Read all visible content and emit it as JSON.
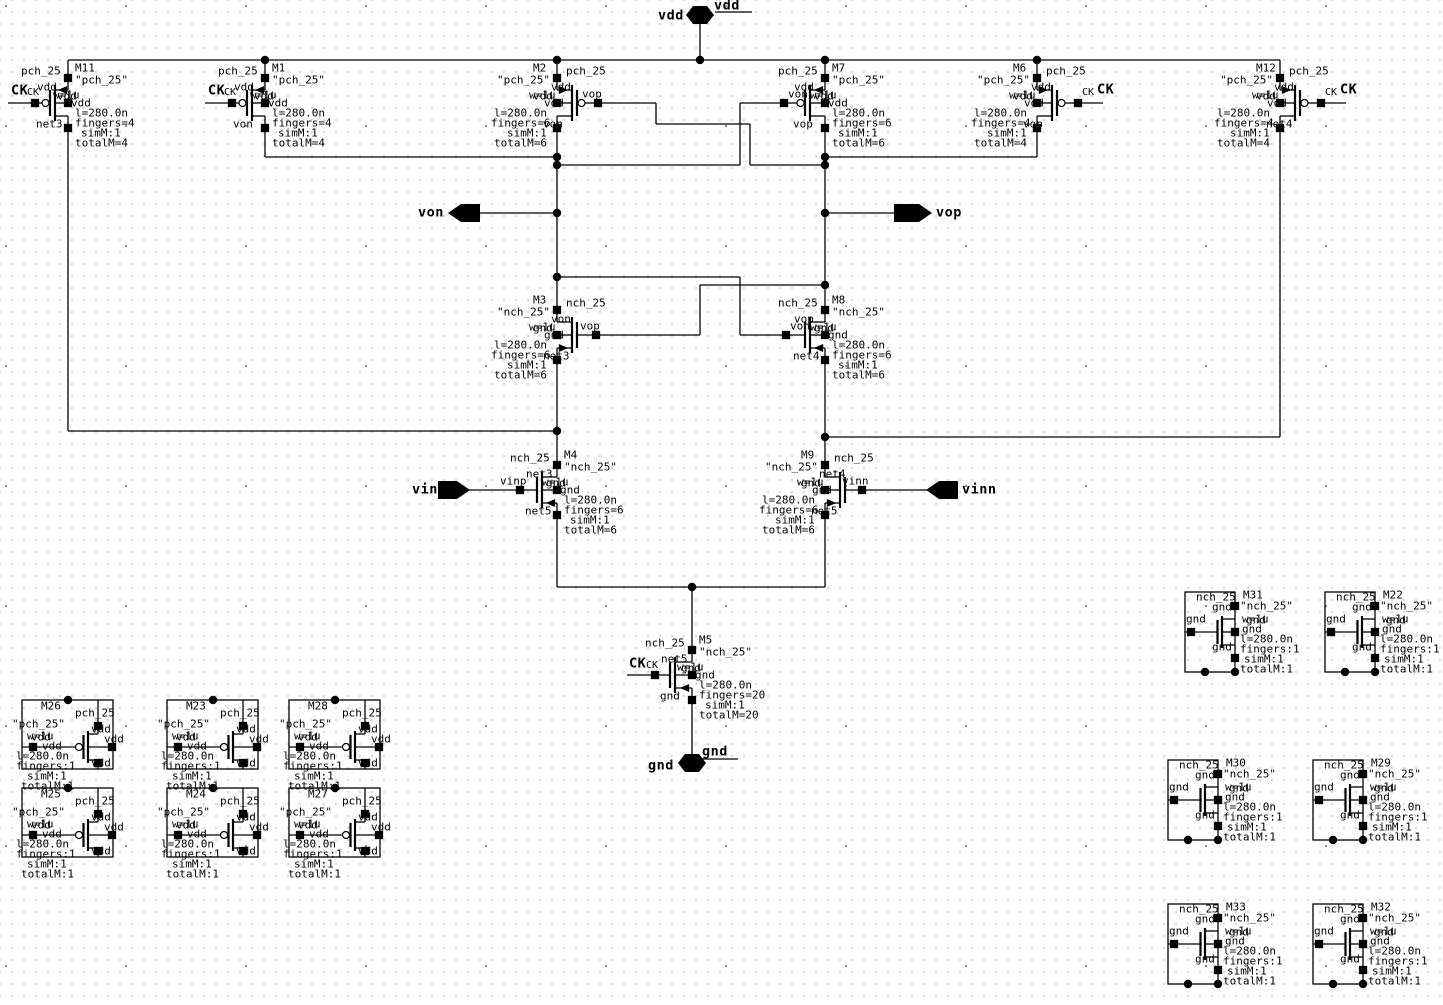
{
  "ports": {
    "vdd": "vdd",
    "gnd": "gnd",
    "von": "von",
    "vop": "vop",
    "vinp": "vinp",
    "vinn": "vinn"
  },
  "transistors": [
    {
      "id": "M11",
      "cell": "pch_25",
      "model": "\"pch_25\"",
      "w": "w=1u",
      "gate": "CK",
      "gate_pin": "CK",
      "pins": {
        "top": "vdd",
        "mid": "vdd",
        "bot": "net3"
      },
      "params": [
        "l=280.0n",
        "fingers=4",
        "simM:1",
        "totalM=4"
      ]
    },
    {
      "id": "M1",
      "cell": "pch_25",
      "model": "\"pch_25\"",
      "w": "w=1u",
      "gate": "CK",
      "gate_pin": "CK",
      "pins": {
        "top": "vdd",
        "mid": "vdd",
        "bot": "von"
      },
      "params": [
        "l=280.0n",
        "fingers=4",
        "simM:1",
        "totalM=4"
      ]
    },
    {
      "id": "M2",
      "cell": "pch_25",
      "model": "\"pch_25\"",
      "w": "w=1u",
      "gate": "vop",
      "pins": {
        "top": "vdd",
        "mid": "vdd",
        "bot": "von"
      },
      "params": [
        "l=280.0n",
        "fingers=6",
        "simM:1",
        "totalM=6"
      ]
    },
    {
      "id": "M7",
      "cell": "pch_25",
      "model": "\"pch_25\"",
      "w": "w=1u",
      "gate": "von",
      "pins": {
        "top": "vdd",
        "mid": "vdd",
        "bot": "vop"
      },
      "params": [
        "l=280.0n",
        "fingers=6",
        "simM:1",
        "totalM=6"
      ]
    },
    {
      "id": "M6",
      "cell": "pch_25",
      "model": "\"pch_25\"",
      "w": "w=1u",
      "gate": "CK",
      "gate_pin": "CK",
      "pins": {
        "top": "vdd",
        "mid": "vdd",
        "bot": "vop"
      },
      "params": [
        "l=280.0n",
        "fingers=4",
        "simM:1",
        "totalM=4"
      ]
    },
    {
      "id": "M12",
      "cell": "pch_25",
      "model": "\"pch_25\"",
      "w": "w=1u",
      "gate": "CK",
      "gate_pin": "CK",
      "pins": {
        "top": "vdd",
        "mid": "vdd",
        "bot": "net4"
      },
      "params": [
        "l=280.0n",
        "fingers=4",
        "simM:1",
        "totalM=4"
      ]
    },
    {
      "id": "M3",
      "cell": "nch_25",
      "model": "\"nch_25\"",
      "w": "w=1u",
      "gate": "vop",
      "pins": {
        "top": "von",
        "mid": "gnd",
        "bot": "net3"
      },
      "params": [
        "l=280.0n",
        "fingers=6",
        "simM:1",
        "totalM=6"
      ]
    },
    {
      "id": "M8",
      "cell": "nch_25",
      "model": "\"nch_25\"",
      "w": "w=1u",
      "gate": "von",
      "pins": {
        "top": "vop",
        "mid": "gnd",
        "bot": "net4"
      },
      "params": [
        "l=280.0n",
        "fingers=6",
        "simM:1",
        "totalM=6"
      ]
    },
    {
      "id": "M4",
      "cell": "nch_25",
      "model": "\"nch_25\"",
      "w": "w=1u",
      "gate": "vinp",
      "pins": {
        "top": "net3",
        "mid": "gnd",
        "bot": "net5"
      },
      "params": [
        "l=280.0n",
        "fingers=6",
        "simM:1",
        "totalM=6"
      ]
    },
    {
      "id": "M9",
      "cell": "nch_25",
      "model": "\"nch_25\"",
      "w": "w=1u",
      "gate": "vinn",
      "pins": {
        "top": "net4",
        "mid": "gnd",
        "bot": "net5"
      },
      "params": [
        "l=280.0n",
        "fingers=6",
        "simM:1",
        "totalM=6"
      ]
    },
    {
      "id": "M5",
      "cell": "nch_25",
      "model": "\"nch_25\"",
      "w": "w=1u",
      "gate": "CK",
      "gate_pin": "CK",
      "pins": {
        "top": "net5",
        "mid": "gnd",
        "bot": "gnd"
      },
      "params": [
        "l=280.0n",
        "fingers=20",
        "simM:1",
        "totalM=20"
      ]
    },
    {
      "id": "M26",
      "cell": "pch_25",
      "model": "\"pch_25\"",
      "w": "w=1u",
      "gate": "vdd",
      "pins": {
        "top": "vdd",
        "mid": "vdd",
        "bot": "vdd"
      },
      "params": [
        "l=280.0n",
        "fingers:1",
        "simM:1",
        "totalM:1"
      ]
    },
    {
      "id": "M25",
      "cell": "pch_25",
      "model": "\"pch_25\"",
      "w": "w=1u",
      "gate": "vdd",
      "pins": {
        "top": "vdd",
        "mid": "vdd",
        "bot": "vdd"
      },
      "params": [
        "l=280.0n",
        "fingers:1",
        "simM:1",
        "totalM:1"
      ]
    },
    {
      "id": "M23",
      "cell": "pch_25",
      "model": "\"pch_25\"",
      "w": "w=1u",
      "gate": "vdd",
      "pins": {
        "top": "vdd",
        "mid": "vdd",
        "bot": "vdd"
      },
      "params": [
        "l=280.0n",
        "fingers:1",
        "simM:1",
        "totalM:1"
      ]
    },
    {
      "id": "M24",
      "cell": "pch_25",
      "model": "\"pch_25\"",
      "w": "w=1u",
      "gate": "vdd",
      "pins": {
        "top": "vdd",
        "mid": "vdd",
        "bot": "vdd"
      },
      "params": [
        "l=280.0n",
        "fingers:1",
        "simM:1",
        "totalM:1"
      ]
    },
    {
      "id": "M28",
      "cell": "pch_25",
      "model": "\"pch_25\"",
      "w": "w=1u",
      "gate": "vdd",
      "pins": {
        "top": "vdd",
        "mid": "vdd",
        "bot": "vdd"
      },
      "params": [
        "l=280.0n",
        "fingers:1",
        "simM:1",
        "totalM:1"
      ]
    },
    {
      "id": "M27",
      "cell": "pch_25",
      "model": "\"pch_25\"",
      "w": "w=1u",
      "gate": "vdd",
      "pins": {
        "top": "vdd",
        "mid": "vdd",
        "bot": "vdd"
      },
      "params": [
        "l=280.0n",
        "fingers:1",
        "simM:1",
        "totalM:1"
      ]
    },
    {
      "id": "M31",
      "cell": "nch_25",
      "model": "\"nch_25\"",
      "w": "w=1u",
      "gate": "gnd",
      "pins": {
        "top": "gnd",
        "mid": "gnd",
        "bot": "gnd"
      },
      "params": [
        "l=280.0n",
        "fingers:1",
        "simM:1",
        "totalM:1"
      ]
    },
    {
      "id": "M22",
      "cell": "nch_25",
      "model": "\"nch_25\"",
      "w": "w=1u",
      "gate": "gnd",
      "pins": {
        "top": "gnd",
        "mid": "gnd",
        "bot": "gnd"
      },
      "params": [
        "l=280.0n",
        "fingers:1",
        "simM:1",
        "totalM:1"
      ]
    },
    {
      "id": "M30",
      "cell": "nch_25",
      "model": "\"nch_25\"",
      "w": "w=1u",
      "gate": "gnd",
      "pins": {
        "top": "gnd",
        "mid": "gnd",
        "bot": "gnd"
      },
      "params": [
        "l=280.0n",
        "fingers:1",
        "simM:1",
        "totalM:1"
      ]
    },
    {
      "id": "M29",
      "cell": "nch_25",
      "model": "\"nch_25\"",
      "w": "w=1u",
      "gate": "gnd",
      "pins": {
        "top": "gnd",
        "mid": "gnd",
        "bot": "gnd"
      },
      "params": [
        "l=280.0n",
        "fingers:1",
        "simM:1",
        "totalM:1"
      ]
    },
    {
      "id": "M33",
      "cell": "nch_25",
      "model": "\"nch_25\"",
      "w": "w=1u",
      "gate": "gnd",
      "pins": {
        "top": "gnd",
        "mid": "gnd",
        "bot": "gnd"
      },
      "params": [
        "l=280.0n",
        "fingers:1",
        "simM:1",
        "totalM:1"
      ]
    },
    {
      "id": "M32",
      "cell": "nch_25",
      "model": "\"nch_25\"",
      "w": "w=1u",
      "gate": "gnd",
      "pins": {
        "top": "gnd",
        "mid": "gnd",
        "bot": "gnd"
      },
      "params": [
        "l=280.0n",
        "fingers:1",
        "simM:1",
        "totalM:1"
      ]
    }
  ]
}
